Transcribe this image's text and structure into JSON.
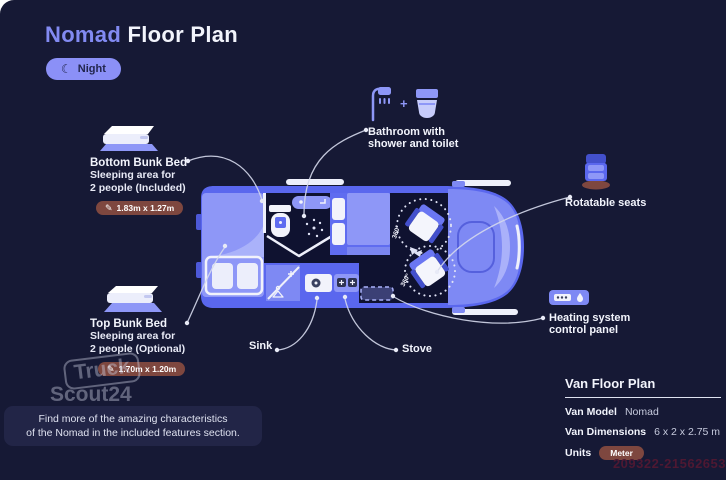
{
  "header": {
    "title_accent": "Nomad",
    "title_rest": "Floor Plan",
    "night_label": "Night"
  },
  "icons": {
    "moon": "☾",
    "pencil": "✎",
    "plus": "+"
  },
  "callouts": {
    "bathroom": {
      "line1": "Bathroom with",
      "line2": "shower and toilet"
    },
    "bottom_bunk": {
      "title": "Bottom Bunk Bed",
      "desc1": "Sleeping area for",
      "desc2": "2 people (Included)",
      "dimensions": "1.83m x 1.27m"
    },
    "top_bunk": {
      "title": "Top Bunk Bed",
      "desc1": "Sleeping area for",
      "desc2": "2 people (Optional)",
      "dimensions": "1.70m x 1.20m"
    },
    "rotatable_seats": {
      "label": "Rotatable seats"
    },
    "heating": {
      "line1": "Heating system",
      "line2": "control panel"
    },
    "sink": {
      "label": "Sink"
    },
    "stove": {
      "label": "Stove"
    }
  },
  "plan": {
    "rotation_label": "360°"
  },
  "note": {
    "line1": "Find more of the amazing characteristics",
    "line2": "of the Nomad in the included features section."
  },
  "spec_panel": {
    "title": "Van Floor Plan",
    "rows": [
      {
        "label": "Van Model",
        "value": "Nomad"
      },
      {
        "label": "Van Dimensions",
        "value": "6 x 2 x 2.75 m"
      },
      {
        "label": "Units",
        "value": "Meter"
      }
    ]
  },
  "watermark": {
    "brand_top": "Truck",
    "brand_bottom": "Scout24",
    "ref_number": "209322-21562653"
  },
  "colors": {
    "background": "#161935",
    "accent": "#828af2",
    "night_pill": "#8b90f7",
    "dimension_badge": "#7e473f",
    "van_body": "#5a67ee",
    "bed": "#8e97f7",
    "interior_dark": "#0f1230",
    "leader_line": "#d5d9ec"
  }
}
